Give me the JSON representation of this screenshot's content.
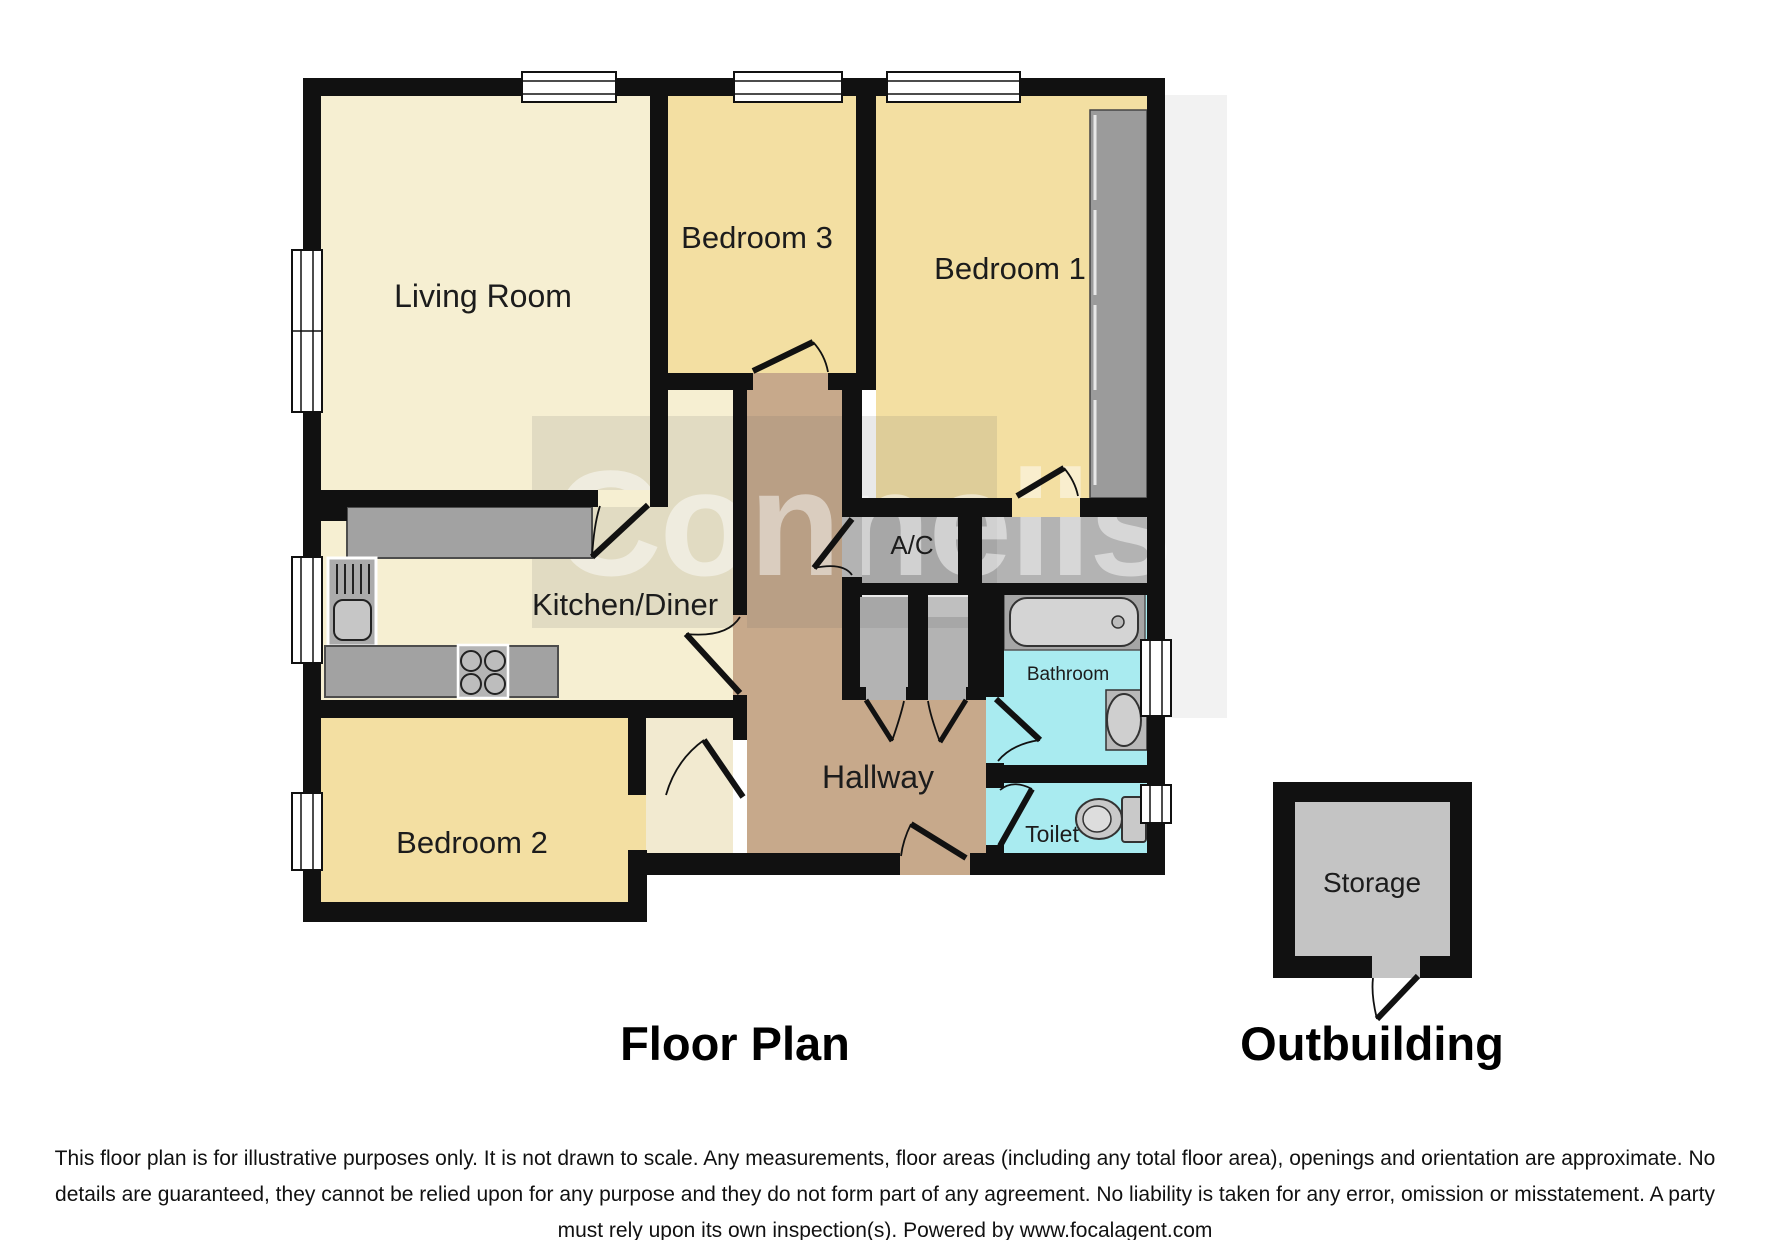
{
  "plan": {
    "rooms": {
      "living_room": "Living Room",
      "bedroom_1": "Bedroom 1",
      "bedroom_2": "Bedroom 2",
      "bedroom_3": "Bedroom 3",
      "kitchen_diner": "Kitchen/Diner",
      "hallway": "Hallway",
      "bathroom": "Bathroom",
      "toilet": "Toilet",
      "ac": "A/C",
      "storage": "Storage"
    },
    "titles": {
      "floor_plan": "Floor Plan",
      "outbuilding": "Outbuilding"
    },
    "watermark": "Connells",
    "disclaimer": {
      "line1": "This floor plan is for illustrative purposes only. It is not drawn to scale. Any measurements, floor areas (including any total floor area), openings and orientation are approximate. No",
      "line2": "details are guaranteed, they cannot be relied upon for any purpose and they do not form part of any agreement. No liability is taken for any error, omission or misstatement. A party",
      "line3": "must rely upon its own inspection(s). Powered by www.focalagent.com"
    },
    "colors": {
      "wall": "#111111",
      "cream_floor": "#f6efd2",
      "bedroom_floor": "#f3dfa2",
      "hallway_floor": "#c7a98b",
      "closet_floor": "#b3b3b3",
      "bathroom_floor": "#a9ebf0",
      "counter_gray": "#a2a2a2",
      "storage_floor": "#c4c4c4",
      "watermark_tint": "rgba(100,100,100,0.14)"
    }
  }
}
